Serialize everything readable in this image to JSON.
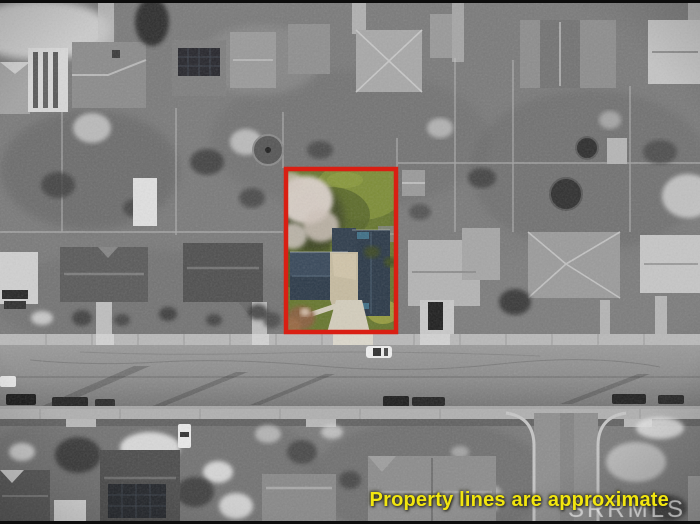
{
  "overlay": {
    "caption": "Property lines are approximate",
    "watermark": "SRRMLS"
  },
  "colors": {
    "boundary_red": "#d91f13",
    "caption_yellow": "#f2e60f",
    "watermark_gray": "rgba(238,238,238,0.52)",
    "lot_lawn_green": "#66762e",
    "lot_roof_slate": "#2c3a49",
    "lot_driveway_tan": "#d3cdbc"
  }
}
